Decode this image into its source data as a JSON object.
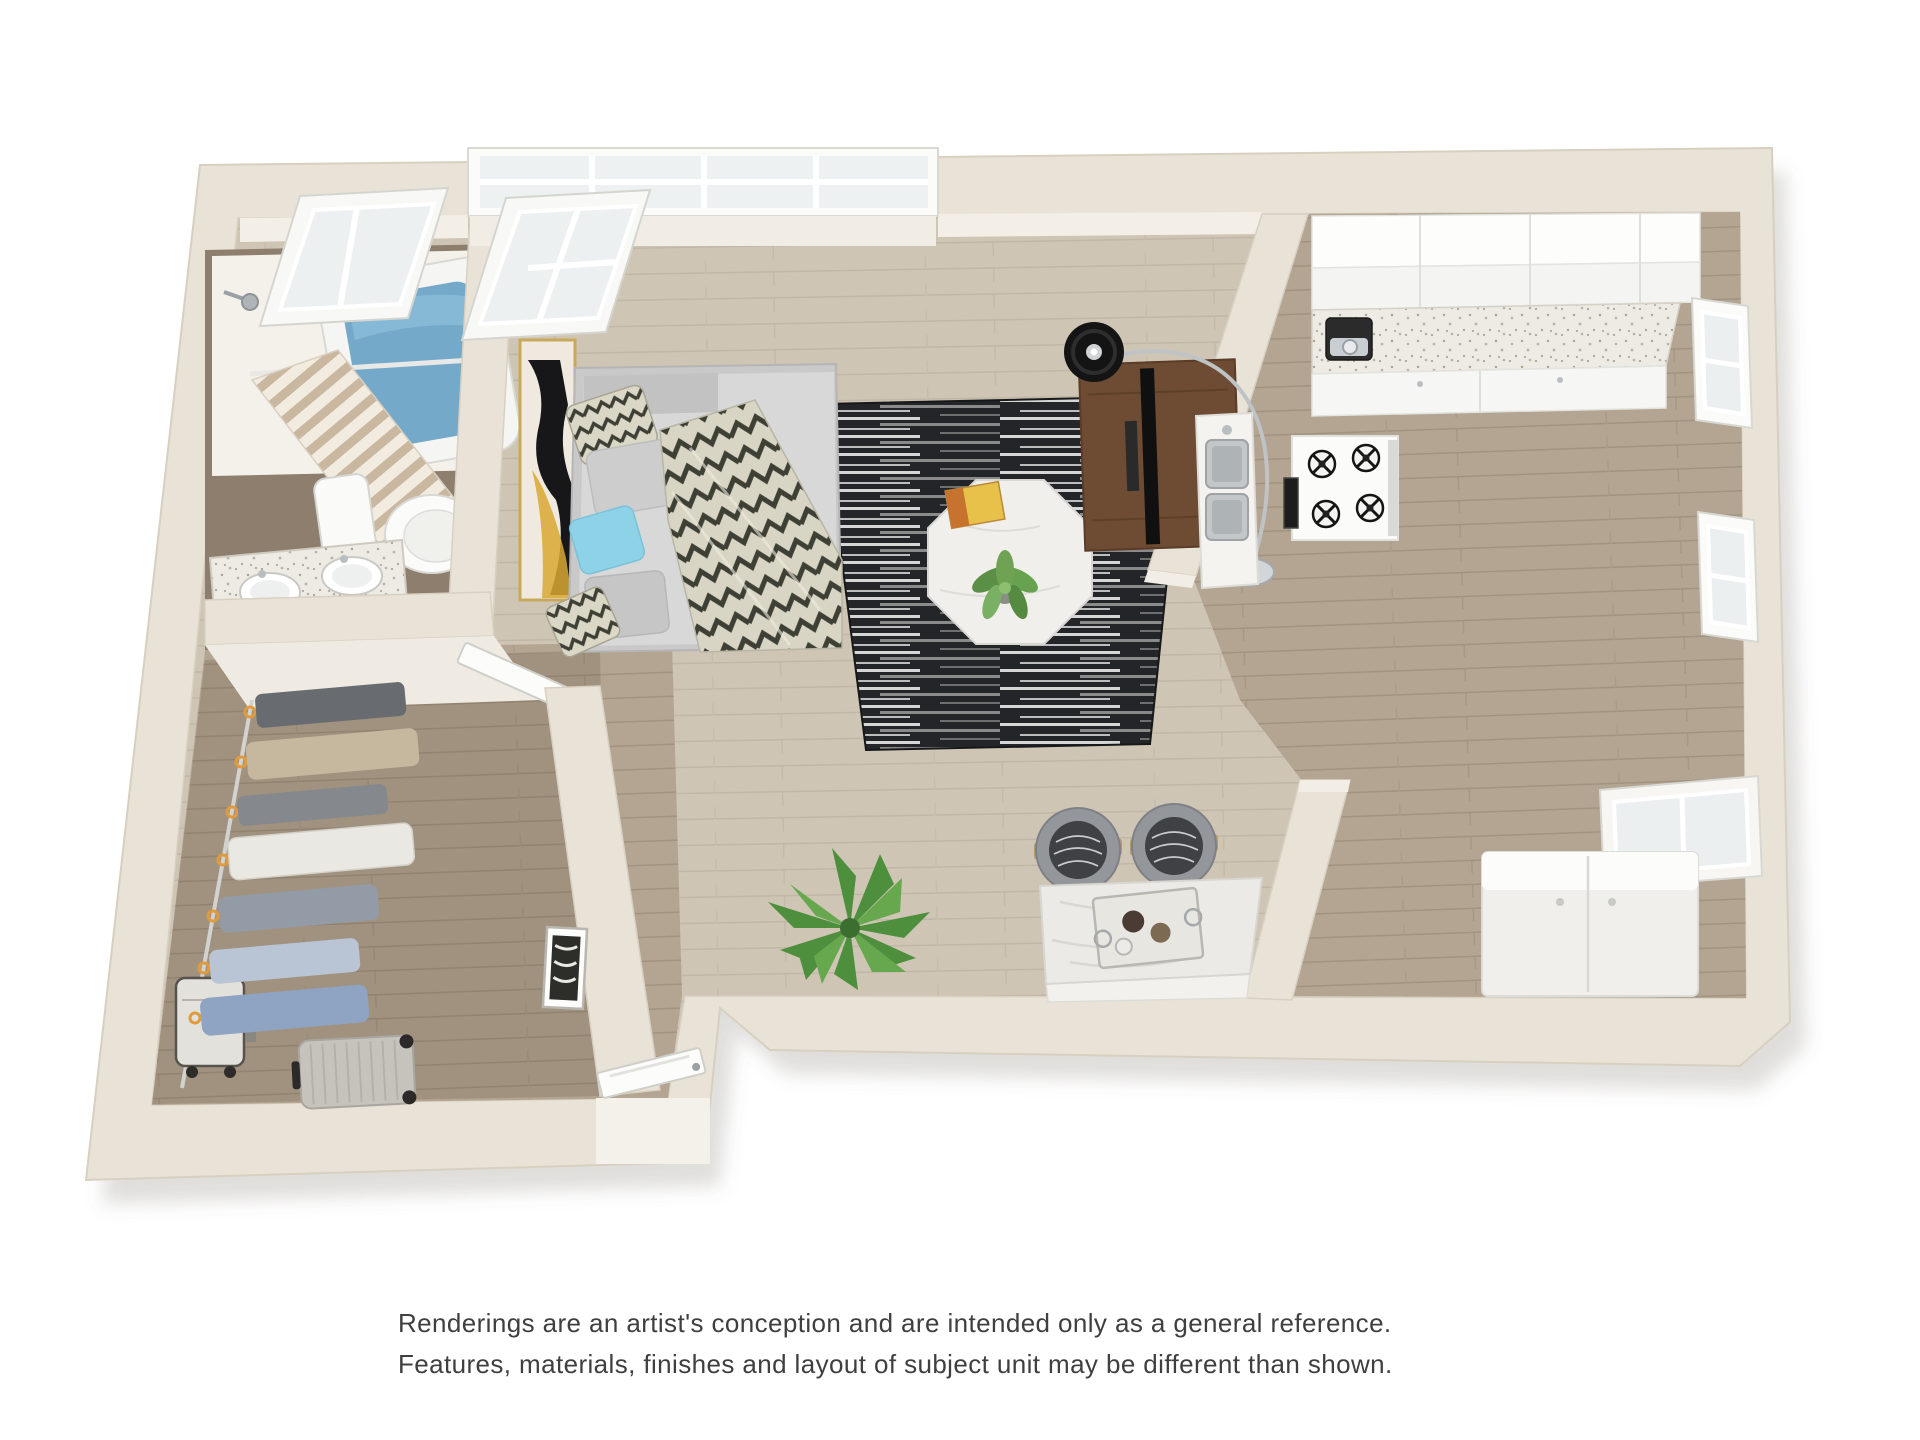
{
  "image_type": "3d-floor-plan-rendering",
  "disclaimer": {
    "line1": "Renderings are an artist's conception and are intended only as a general reference.",
    "line2": "Features, materials, finishes and layout of subject unit may be different than shown."
  },
  "palette": {
    "background": "#ffffff",
    "wall_cream": "#e9e3d7",
    "wall_edge": "#d7cfc0",
    "floor_light_wood": "#cfc5b5",
    "floor_dark_wood": "#b3a591",
    "rug_dark": "#232528",
    "accent_blue_pillow": "#8ed2e8",
    "tub_water_blue": "#74a9c9",
    "marble_white": "#f0efec",
    "walnut_console": "#6e4b33",
    "hanger_orange": "#e09b3d",
    "plant_green": "#5c8f46"
  },
  "rooms": [
    {
      "name": "bathroom",
      "fixtures": [
        "skylight-window",
        "shower-head",
        "shower-curtain",
        "bathtub",
        "toilet",
        "vanity-double-sink"
      ]
    },
    {
      "name": "walk-in-closet",
      "fixtures": [
        "closet-rod",
        "hanging-clothes",
        "laundry-hamper",
        "suitcase"
      ]
    },
    {
      "name": "entry-hall",
      "fixtures": [
        "entry-door",
        "chevron-wall-art",
        "bathroom-door"
      ]
    },
    {
      "name": "living-bedroom",
      "fixtures": [
        "picture-window",
        "skylight-window",
        "abstract-wall-art",
        "bed-with-pillows",
        "chevron-throw-blanket",
        "area-rug",
        "octagon-coffee-table",
        "table-plant",
        "magazine",
        "arc-floor-lamp",
        "tv-console",
        "tv"
      ]
    },
    {
      "name": "kitchen",
      "fixtures": [
        "upper-cabinets",
        "speckled-countertop",
        "coffee-maker",
        "double-sink",
        "gas-stove",
        "oven",
        "window",
        "window",
        "window",
        "refrigerator"
      ]
    },
    {
      "name": "dining-nook",
      "fixtures": [
        "kitchen-island",
        "bar-stool",
        "bar-stool",
        "serving-tray",
        "floor-plant"
      ]
    }
  ]
}
